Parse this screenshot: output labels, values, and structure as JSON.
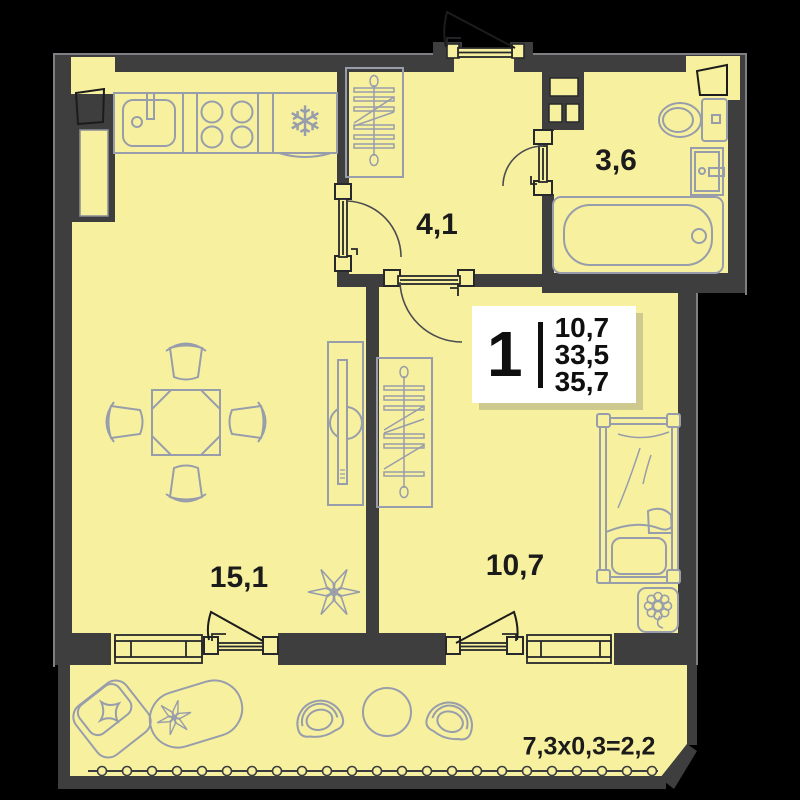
{
  "palette": {
    "background": "#000000",
    "floor": "#F7F19F",
    "wall": "#3E3E3E",
    "furniture_outline": "#989DAB",
    "line_dark": "#26282B",
    "text": "#1B1B1B",
    "card_bg": "#FFFFFF",
    "card_shadow": "#CDC98F"
  },
  "rooms": [
    {
      "id": "kitchen-living",
      "area": "15,1"
    },
    {
      "id": "hallway",
      "area": "4,1"
    },
    {
      "id": "bathroom",
      "area": "3,6"
    },
    {
      "id": "bedroom",
      "area": "10,7"
    }
  ],
  "balcony": {
    "dimension": "7,3x0,3=2,2"
  },
  "info_card": {
    "rooms_count": "1",
    "areas": [
      "10,7",
      "33,5",
      "35,7"
    ]
  },
  "icons": {
    "fridge_snowflake": "❄"
  }
}
